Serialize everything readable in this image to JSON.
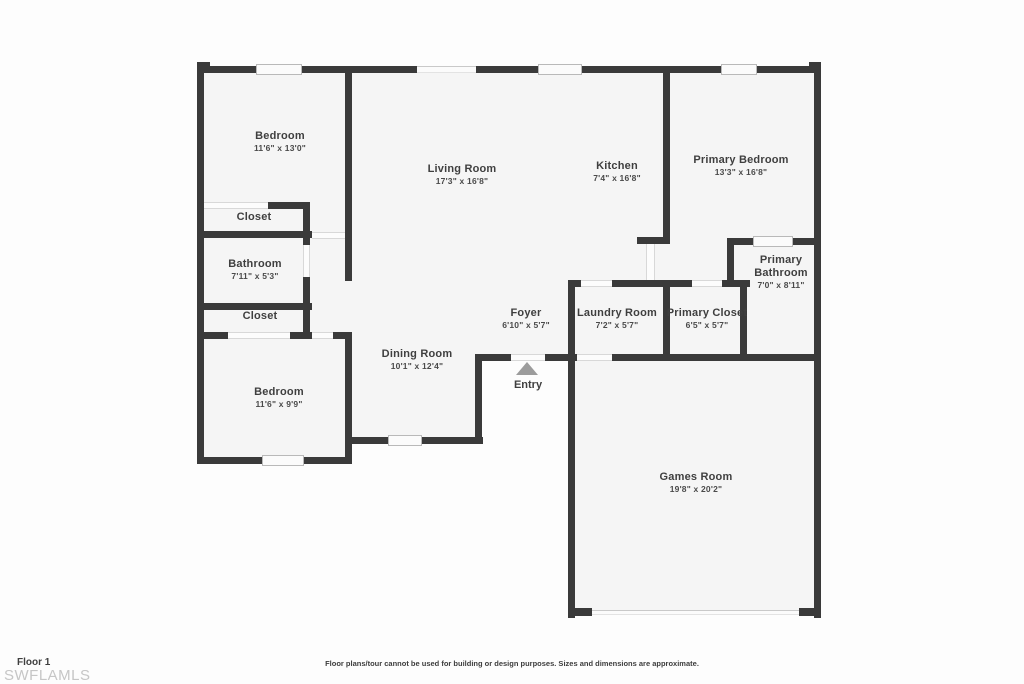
{
  "colors": {
    "wall": "#3a3a3a",
    "room_fill": "#f5f5f5",
    "opening_line": "#d8d8d8",
    "entry_arrow": "#9c9c9c",
    "label_text": "#3f3f3f",
    "watermark_text": "#c6c6c6"
  },
  "rooms": [
    {
      "name": "Bedroom",
      "dims": "11'6\" x 13'0\""
    },
    {
      "name": "Closet",
      "dims": ""
    },
    {
      "name": "Bathroom",
      "dims": "7'11\" x 5'3\""
    },
    {
      "name": "Closet",
      "dims": ""
    },
    {
      "name": "Bedroom",
      "dims": "11'6\" x 9'9\""
    },
    {
      "name": "Dining Room",
      "dims": "10'1\" x 12'4\""
    },
    {
      "name": "Living Room",
      "dims": "17'3\" x 16'8\""
    },
    {
      "name": "Kitchen",
      "dims": "7'4\" x 16'8\""
    },
    {
      "name": "Primary Bedroom",
      "dims": "13'3\" x 16'8\""
    },
    {
      "name": "Primary Bathroom",
      "dims": "7'0\" x 8'11\""
    },
    {
      "name": "Foyer",
      "dims": "6'10\" x 5'7\""
    },
    {
      "name": "Laundry Room",
      "dims": "7'2\" x 5'7\""
    },
    {
      "name": "Primary Closet",
      "dims": "6'5\" x 5'7\""
    },
    {
      "name": "Games Room",
      "dims": "19'8\" x 20'2\""
    }
  ],
  "entry": {
    "label": "Entry"
  },
  "footer": {
    "floor_label": "Floor 1",
    "watermark": "SWFLAMLS",
    "disclaimer": "Floor plans/tour cannot be used for building or design purposes. Sizes and dimensions are approximate."
  }
}
